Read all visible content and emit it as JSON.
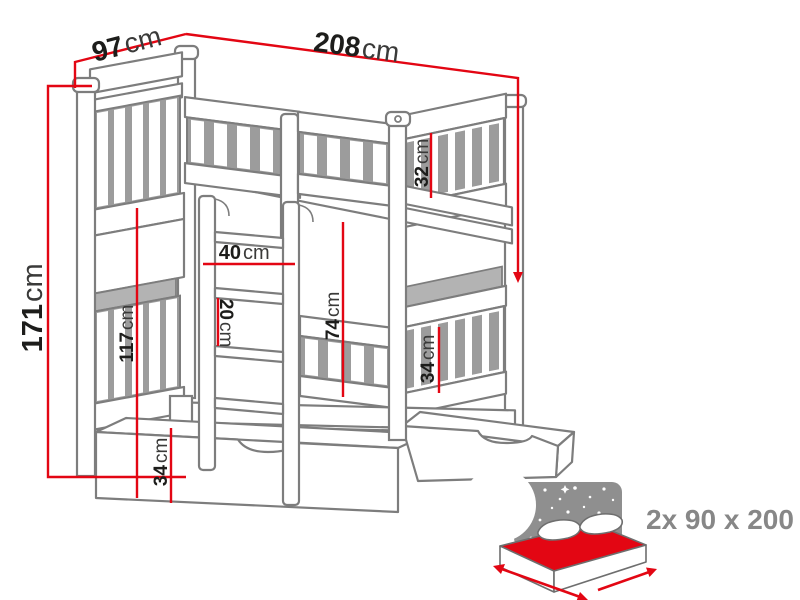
{
  "diagram": {
    "type": "bunk-bed-dimension-drawing",
    "dimensions": {
      "depth_top": {
        "value": "97",
        "unit": "cm"
      },
      "length_top": {
        "value": "208",
        "unit": "cm"
      },
      "height_total": {
        "value": "171",
        "unit": "cm"
      },
      "height_under_top_bunk": {
        "value": "117",
        "unit": "cm"
      },
      "ladder_width": {
        "value": "40",
        "unit": "cm"
      },
      "rung_spacing": {
        "value": "20",
        "unit": "cm"
      },
      "lower_clearance": {
        "value": "74",
        "unit": "cm"
      },
      "top_guardrail": {
        "value": "32",
        "unit": "cm"
      },
      "bottom_guardrail": {
        "value": "34",
        "unit": "cm"
      },
      "drawer_height": {
        "value": "34",
        "unit": "cm"
      }
    },
    "mattress_note": "2x 90 x 200",
    "colors": {
      "dimension_red": "#e30613",
      "drawing_gray": "#7d7d7d",
      "slat_gray": "#9c9c9c",
      "icon_gray": "#8f8f8f",
      "note_gray": "#878787",
      "label_dark": "#1d1d1b",
      "background": "#ffffff"
    }
  }
}
